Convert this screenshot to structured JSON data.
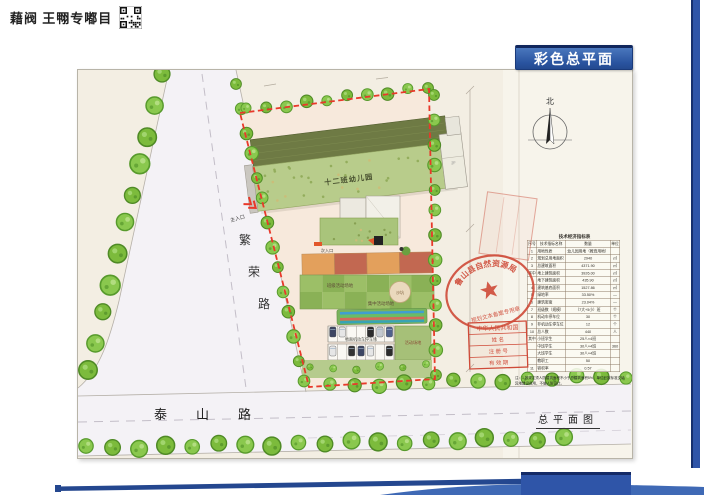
{
  "watermark": {
    "text": "藉阀 王翈专嘟目"
  },
  "slide": {
    "title": "彩色总平面"
  },
  "plan": {
    "building_label": "十二班幼儿园",
    "floor_tag": "2F",
    "roads": {
      "left": "繁荣路",
      "bottom": "泰山路"
    },
    "labels": {
      "class_activity": "班级活动场地",
      "central_activity": "集中活动场地",
      "sand_pit": "沙坑",
      "parking": "地面机动车停车场",
      "activity_field": "活动场地",
      "main_entrance": "主入口",
      "secondary_entrance": "次入口",
      "north": "北"
    },
    "note": "注：1 按规定须人防建筑面积不小于总建筑面积5%，单位已按标准交纳异地建设费用，不做人防设计。",
    "drawing_title": "总平面图"
  },
  "stamps": {
    "oval": {
      "top": "鲁山县自然资源局",
      "bottom": "规划文本备案专用章"
    },
    "registry": {
      "rows": [
        "中华人民共和国",
        "姓  名",
        "注 册 号",
        "有 效 期"
      ]
    }
  },
  "table": {
    "title": "技术经济指标表",
    "headers": [
      "序号",
      "技术指标名称",
      "数量",
      "单位"
    ],
    "rows": [
      [
        "1",
        "用地性质",
        "幼儿园用地（教育用地）",
        ""
      ],
      [
        "2",
        "规划总用地面积",
        "2940",
        "㎡"
      ],
      [
        "3",
        "总建筑面积",
        "4371.90",
        "㎡"
      ],
      [
        "其中",
        "地上建筑面积",
        "3926.00",
        "㎡"
      ],
      [
        "",
        "地下建筑面积",
        "435.90",
        "㎡"
      ],
      [
        "4",
        "建筑基底面积",
        "1527.86",
        "㎡"
      ],
      [
        "5",
        "绿地率",
        "33.50%",
        "—"
      ],
      [
        "6",
        "建筑密度",
        "23.04%",
        "—"
      ],
      [
        "7",
        "班级数（规模）",
        "（7大+5小）班",
        "个"
      ],
      [
        "8",
        "机动车停车位",
        "30",
        "个"
      ],
      [
        "9",
        "非机动车停车位",
        "12",
        "个"
      ],
      [
        "10",
        "总人数",
        "440",
        "人"
      ],
      [
        "其中",
        "小班学生",
        "25人×4班",
        ""
      ],
      [
        "",
        "中班学生",
        "30人×4班",
        "360"
      ],
      [
        "",
        "大班学生",
        "30人×4班",
        ""
      ],
      [
        "",
        "教职工",
        "50",
        ""
      ],
      [
        "11",
        "容积率",
        "0.57",
        ""
      ]
    ]
  },
  "colors": {
    "accent_blue": "#2f55a8",
    "boundary_red": "#e8392a",
    "stamp_red": "#cf4a38",
    "tree_green": "#7cbb3c"
  }
}
